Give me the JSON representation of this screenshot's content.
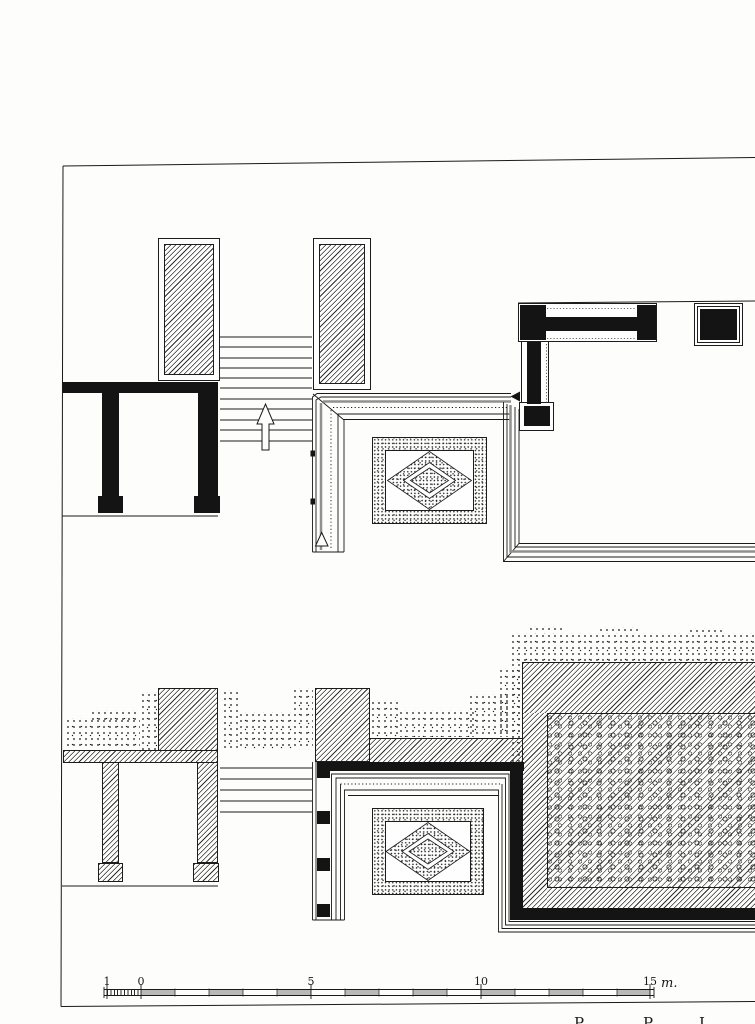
{
  "scale_bar": {
    "tick_labels": [
      "1",
      "0",
      "5",
      "10",
      "15"
    ],
    "unit_label": "m."
  },
  "caption": {
    "fragments": [
      "P",
      "P",
      "I"
    ]
  },
  "colors": {
    "ink": "#1a1a1a",
    "paper": "#fdfdfb",
    "thick_line_gray": "#909090",
    "scale_shade_gray": "#b9b9b9"
  }
}
